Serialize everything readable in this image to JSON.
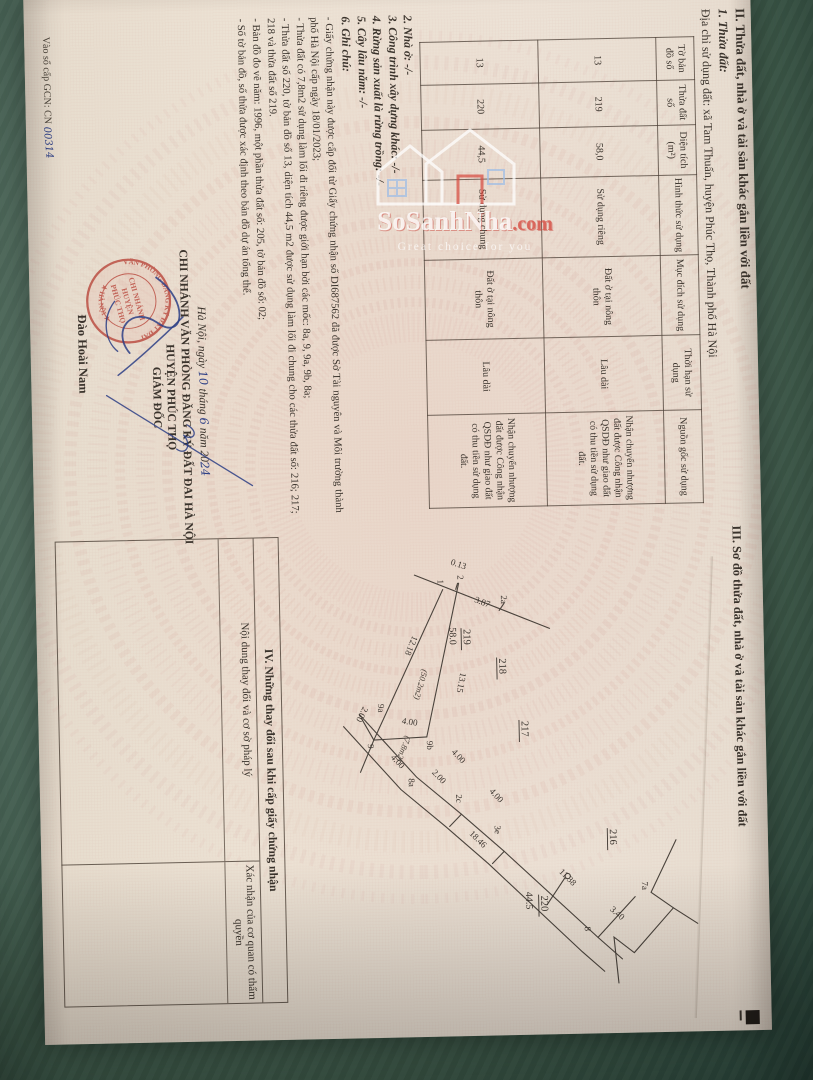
{
  "watermark": {
    "brand": "SoSanhNha",
    "tld": ".com",
    "tagline": "Great choice for you"
  },
  "page_left": {
    "section2_title": "II. Thửa đất, nhà ở và tài sản khác gắn liền với đất",
    "item1_label": "1. Thửa đất:",
    "address_line": "Địa chỉ sử dụng đất: xã Tam Thuấn, huyện Phúc Thọ, Thành phố Hà Nội",
    "land_table": {
      "headers": [
        "Tờ bản đồ số",
        "Thửa đất số",
        "Diện tích (m²)",
        "Hình thức sử dụng",
        "Mục đích sử dụng",
        "Thời hạn sử dụng",
        "Nguồn gốc sử dụng"
      ],
      "rows": [
        [
          "13",
          "219",
          "58,0",
          "Sử dụng riêng",
          "Đất ở tại nông thôn",
          "Lâu dài",
          "Nhận chuyển nhượng đất được Công nhận QSDĐ như giao đất có thu tiền sử dụng đất."
        ],
        [
          "13",
          "220",
          "44,5",
          "Sử dụng chung",
          "Đất ở tại nông thôn",
          "Lâu dài",
          "Nhận chuyển nhượng đất được Công nhận QSDĐ như giao đất có thu tiền sử dụng đất."
        ]
      ]
    },
    "items": [
      "2. Nhà ở: -/-",
      "3. Công trình xây dựng khác: -/-",
      "4. Rừng sản xuất là rừng trồng: -/-",
      "5. Cây lâu năm: -/-",
      "6. Ghi chú:"
    ],
    "notes": [
      "- Giấy chứng nhận này được cấp đổi từ Giấy chứng nhận số DI687562 đã được Sở Tài nguyên và Môi trường thành phố Hà Nội cấp ngày 18/01/2023;",
      "- Thửa đất có 7,8m2 sử dụng làm lối đi riêng được giới hạn bởi các mốc: 8a, 9, 9a, 9b, 8a;",
      "- Thửa đất số 220, tờ bản đồ số 13, diện tích 44,5 m2 được sử dụng làm lối đi chung cho các thửa đất số: 216; 217; 218 và thửa đất số 219.",
      "- Bản đồ đo vẽ năm: 1996, một phần thửa đất số: 205, tờ bản đồ số: 02;",
      "- Số tờ bản đồ, số thửa được xác định theo bản đồ dự án tổng thể."
    ],
    "date_line": {
      "prefix": "Hà Nội, ngày",
      "day": "10",
      "mid1": "tháng",
      "month": "6",
      "mid2": "năm 20",
      "year": "24"
    },
    "issuer_block": [
      "CHI NHÁNH VĂN PHÒNG ĐĂNG KÝ ĐẤT ĐAI HÀ NỘI",
      "HUYỆN PHÚC THỌ",
      "GIÁM ĐỐC"
    ],
    "signer_name": "Đào Hoài Nam",
    "stamp": {
      "ring_top": "VĂN PHÒNG ĐĂNG KÝ ĐẤT ĐAI",
      "ring_bottom": "★ HÀ NỘI ★",
      "center": [
        "CHI NHÁNH",
        "HUYỆN",
        "PHÚC THỌ"
      ]
    },
    "registry_line": {
      "prefix": "Vào sổ cấp GCN: CN",
      "number": "00314"
    }
  },
  "page_right": {
    "section3_title": "III. Sơ đồ thửa đất, nhà ở và tài sản khác gắn liền với đất",
    "section4_title": "IV. Những thay đổi sau khi cấp giấy chứng nhận",
    "col_left": "Nội dung thay đổi và cơ sở pháp lý",
    "col_right": "Xác nhận của cơ quan có thẩm quyền",
    "diagram": {
      "parcels": [
        {
          "id": "219",
          "area": "58.0",
          "sub_areas": [
            "(50.2m2)",
            "(7.8m2)"
          ]
        },
        {
          "id": "220",
          "area": "44.5"
        },
        {
          "id": "218"
        },
        {
          "id": "217"
        },
        {
          "id": "216"
        }
      ],
      "labels": [
        {
          "t": "0.13",
          "x": 38,
          "y": 260,
          "r": -70,
          "k": "dim"
        },
        {
          "t": "3.87",
          "x": 76,
          "y": 237,
          "r": -68,
          "k": "dim"
        },
        {
          "t": "12.18",
          "x": 108,
          "y": 299,
          "r": 24,
          "k": "dim"
        },
        {
          "t": "13.15",
          "x": 146,
          "y": 252,
          "r": 12,
          "k": "dim"
        },
        {
          "t": "(50.2m2)",
          "x": 142,
          "y": 290,
          "r": 17,
          "k": "area"
        },
        {
          "t": "(7.8m2)",
          "x": 208,
          "y": 308,
          "r": 22,
          "k": "area"
        },
        {
          "t": "4.00",
          "x": 196,
          "y": 312,
          "r": -80,
          "k": "dim"
        },
        {
          "t": "2.00",
          "x": 178,
          "y": 350,
          "r": 28,
          "k": "dim"
        },
        {
          "t": "4.00",
          "x": 230,
          "y": 324,
          "r": -42,
          "k": "dim"
        },
        {
          "t": "2.00",
          "x": 246,
          "y": 283,
          "r": -42,
          "k": "dim"
        },
        {
          "t": "4.00",
          "x": 226,
          "y": 263,
          "r": -42,
          "k": "dim"
        },
        {
          "t": "4.00",
          "x": 266,
          "y": 226,
          "r": -42,
          "k": "dim"
        },
        {
          "t": "18.46",
          "x": 308,
          "y": 247,
          "r": -44,
          "k": "dim"
        },
        {
          "t": "11.38",
          "x": 348,
          "y": 158,
          "r": -44,
          "k": "dim"
        },
        {
          "t": "3.40",
          "x": 387,
          "y": 108,
          "r": -48,
          "k": "dim"
        },
        {
          "t": "1",
          "x": 53,
          "y": 273,
          "r": 0,
          "k": "pt"
        },
        {
          "t": "2",
          "x": 49,
          "y": 253,
          "r": 0,
          "k": "pt"
        },
        {
          "t": "2a",
          "x": 70,
          "y": 210,
          "r": 0,
          "k": "pt"
        },
        {
          "t": "9",
          "x": 216,
          "y": 346,
          "r": 0,
          "k": "pt"
        },
        {
          "t": "9a",
          "x": 176,
          "y": 335,
          "r": 0,
          "k": "pt"
        },
        {
          "t": "9b",
          "x": 214,
          "y": 287,
          "r": 0,
          "k": "pt"
        },
        {
          "t": "8a",
          "x": 251,
          "y": 306,
          "r": 0,
          "k": "pt"
        },
        {
          "t": "2c",
          "x": 268,
          "y": 259,
          "r": 0,
          "k": "pt"
        },
        {
          "t": "3e",
          "x": 300,
          "y": 221,
          "r": 0,
          "k": "pt"
        },
        {
          "t": "8",
          "x": 403,
          "y": 133,
          "r": 0,
          "k": "pt"
        },
        {
          "t": "7a",
          "x": 359,
          "y": 75,
          "r": 0,
          "k": "pt"
        },
        {
          "t": "219",
          "x": 103,
          "y": 248,
          "r": 0,
          "k": "parcel"
        },
        {
          "t": "58.0",
          "x": 101,
          "y": 262,
          "r": 0,
          "k": "sub"
        },
        {
          "t": "218",
          "x": 133,
          "y": 213,
          "r": 0,
          "k": "parcel"
        },
        {
          "t": "217",
          "x": 196,
          "y": 192,
          "r": 0,
          "k": "parcel"
        },
        {
          "t": "216",
          "x": 306,
          "y": 106,
          "r": 0,
          "k": "parcel"
        },
        {
          "t": "220",
          "x": 371,
          "y": 176,
          "r": 0,
          "k": "parcel"
        },
        {
          "t": "44.5",
          "x": 367,
          "y": 191,
          "r": 0,
          "k": "sub"
        }
      ]
    }
  }
}
